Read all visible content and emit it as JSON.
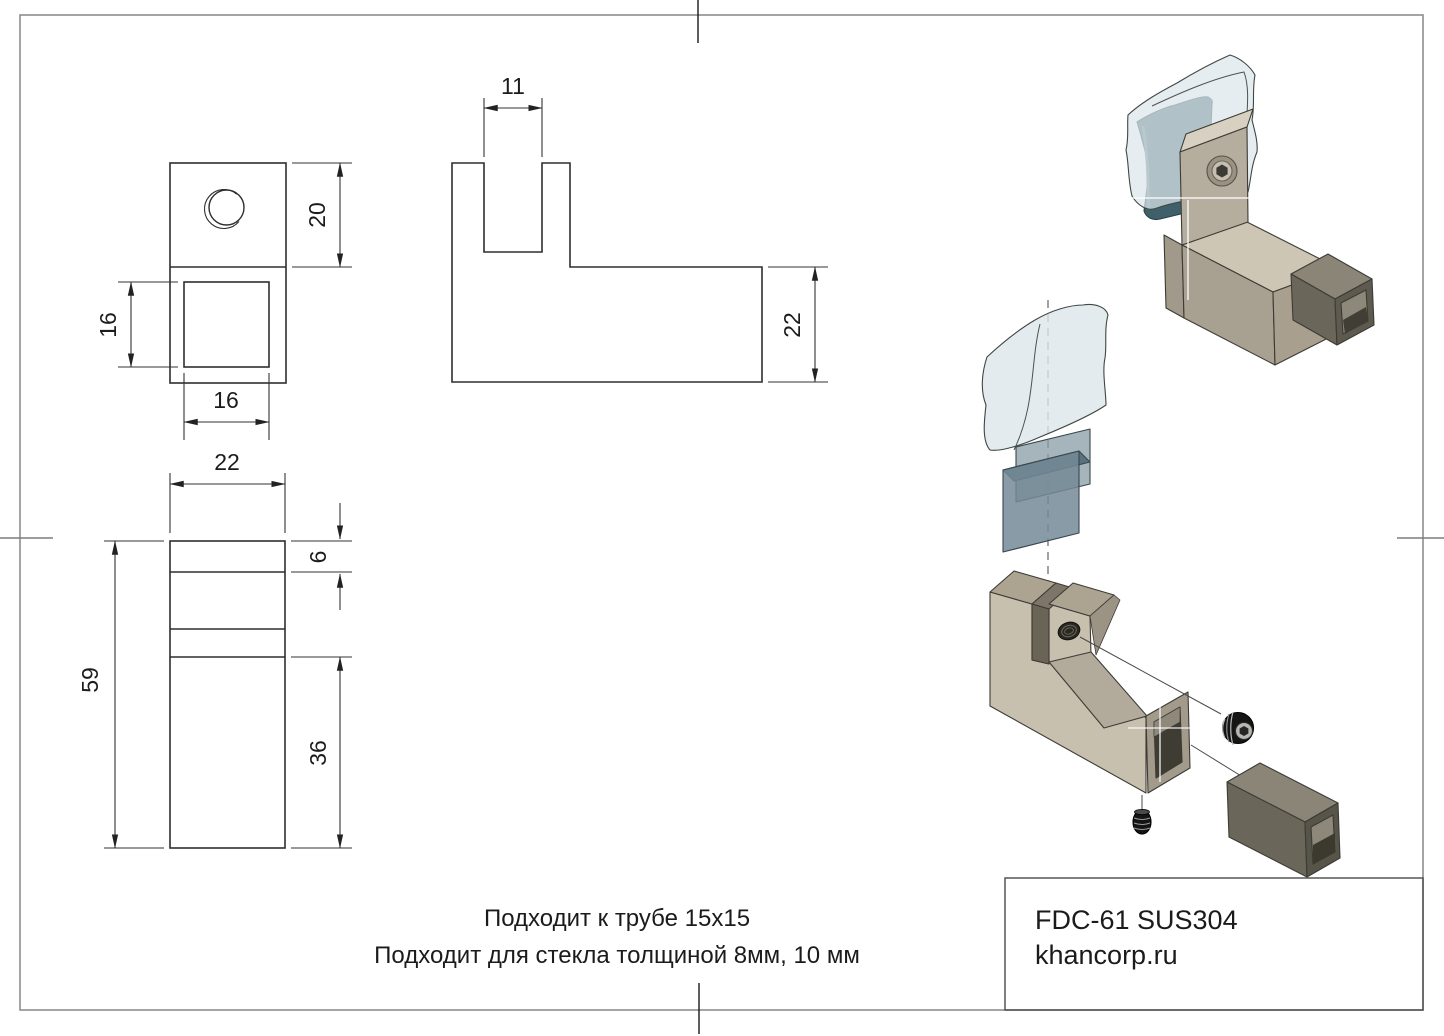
{
  "sheet": {
    "type_label": "technical-drawing",
    "dims": {
      "plate_height": "20",
      "tube_hole_height": "16",
      "tube_hole_width": "16",
      "body_width": "22",
      "slot_width": "11",
      "arm_height": "22",
      "total_height": "59",
      "top_cap": "6",
      "lower_section": "36"
    },
    "notes": {
      "line1": "Подходит к трубе 15x15",
      "line2": "Подходит для стекла толщиной 8мм, 10 мм"
    },
    "title_block": {
      "model": "FDC-61 SUS304",
      "website": "khancorp.ru"
    },
    "colors": {
      "line": "#2e2e2e",
      "frame": "#8d8d8d",
      "metal_bright": "#c7c0af",
      "metal_mid": "#b5ad9d",
      "metal_top": "#d8d1c1",
      "metal_dark": "#a19a8a",
      "tube_top": "#8b8577",
      "tube_front": "#6b665a",
      "tube_end": "#5e5a4f",
      "glass": "#dce6ea",
      "gasket": "#3f606b",
      "screw": "#151515"
    }
  }
}
